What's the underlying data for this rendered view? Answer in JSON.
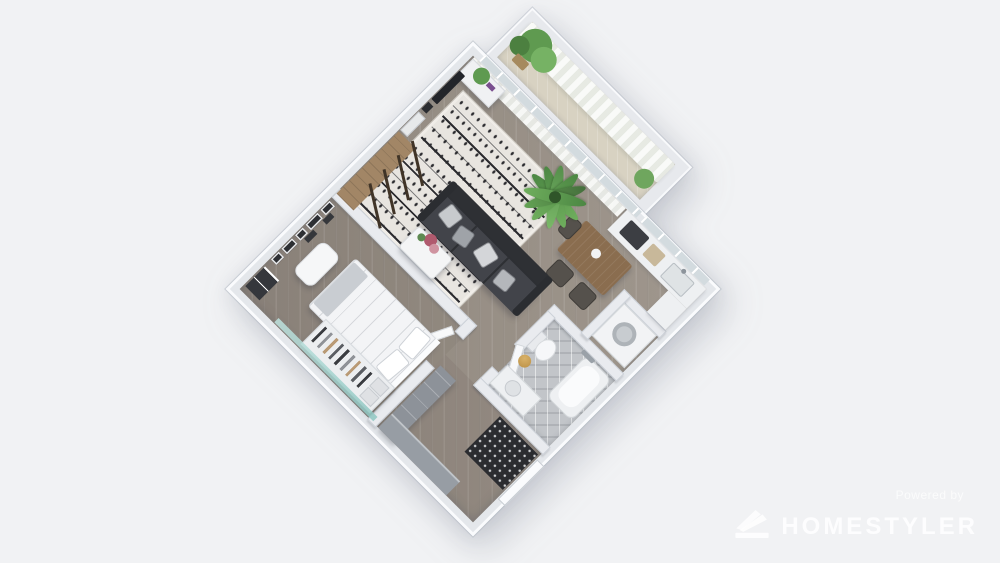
{
  "watermark": {
    "powered_by": "Powered by",
    "brand": "HOMESTYLER"
  },
  "scene": {
    "type": "3d_floor_plan_render_top_view",
    "rotation_deg": 45,
    "background_color": "#f1f2f4",
    "palette": {
      "walls": "#e8eaee",
      "wood_floor": "#9a9187",
      "rug": "#e8e5e0",
      "rug_pattern": "#2c2c30",
      "sofa": "#34363b",
      "plant_green": "#66a356",
      "bathroom_tile": "#c2c5c9",
      "doormat": "#2b2c30",
      "accent_gold": "#c59a4e",
      "teal_glass": "#9fd0cb",
      "dining_wood": "#8a6d4f",
      "watermark": "#ffffff"
    },
    "rooms": [
      {
        "name": "Living Room",
        "furniture": [
          "black-white tribal rug",
          "dark gray three-seat sofa with cushions",
          "white coffee table with flowers",
          "wall TV",
          "art frames",
          "wood console with ladder shelf",
          "tall potted palm",
          "sheer window curtains",
          "corner desk with plant"
        ]
      },
      {
        "name": "Dining / Kitchen",
        "furniture": [
          "wood dining table",
          "dark chairs",
          "kitchen counter with sink",
          "cooktop",
          "washing machine niche",
          "window shelf"
        ]
      },
      {
        "name": "Balcony",
        "furniture": [
          "sheer curtains",
          "potted plants",
          "tan floor"
        ]
      },
      {
        "name": "Bedroom",
        "furniture": [
          "double bed with two pillows",
          "open wardrobe with hanging clothes",
          "white bench",
          "gallery wall picture frames",
          "dark dresser",
          "teal glass panel"
        ]
      },
      {
        "name": "Bathroom",
        "furniture": [
          "bathtub",
          "toilet",
          "vanity with sink",
          "gold stool",
          "gray tile floor"
        ]
      },
      {
        "name": "Entry Hall",
        "furniture": [
          "black dotted doormat",
          "gray shoe cabinets",
          "entry door"
        ]
      }
    ]
  }
}
